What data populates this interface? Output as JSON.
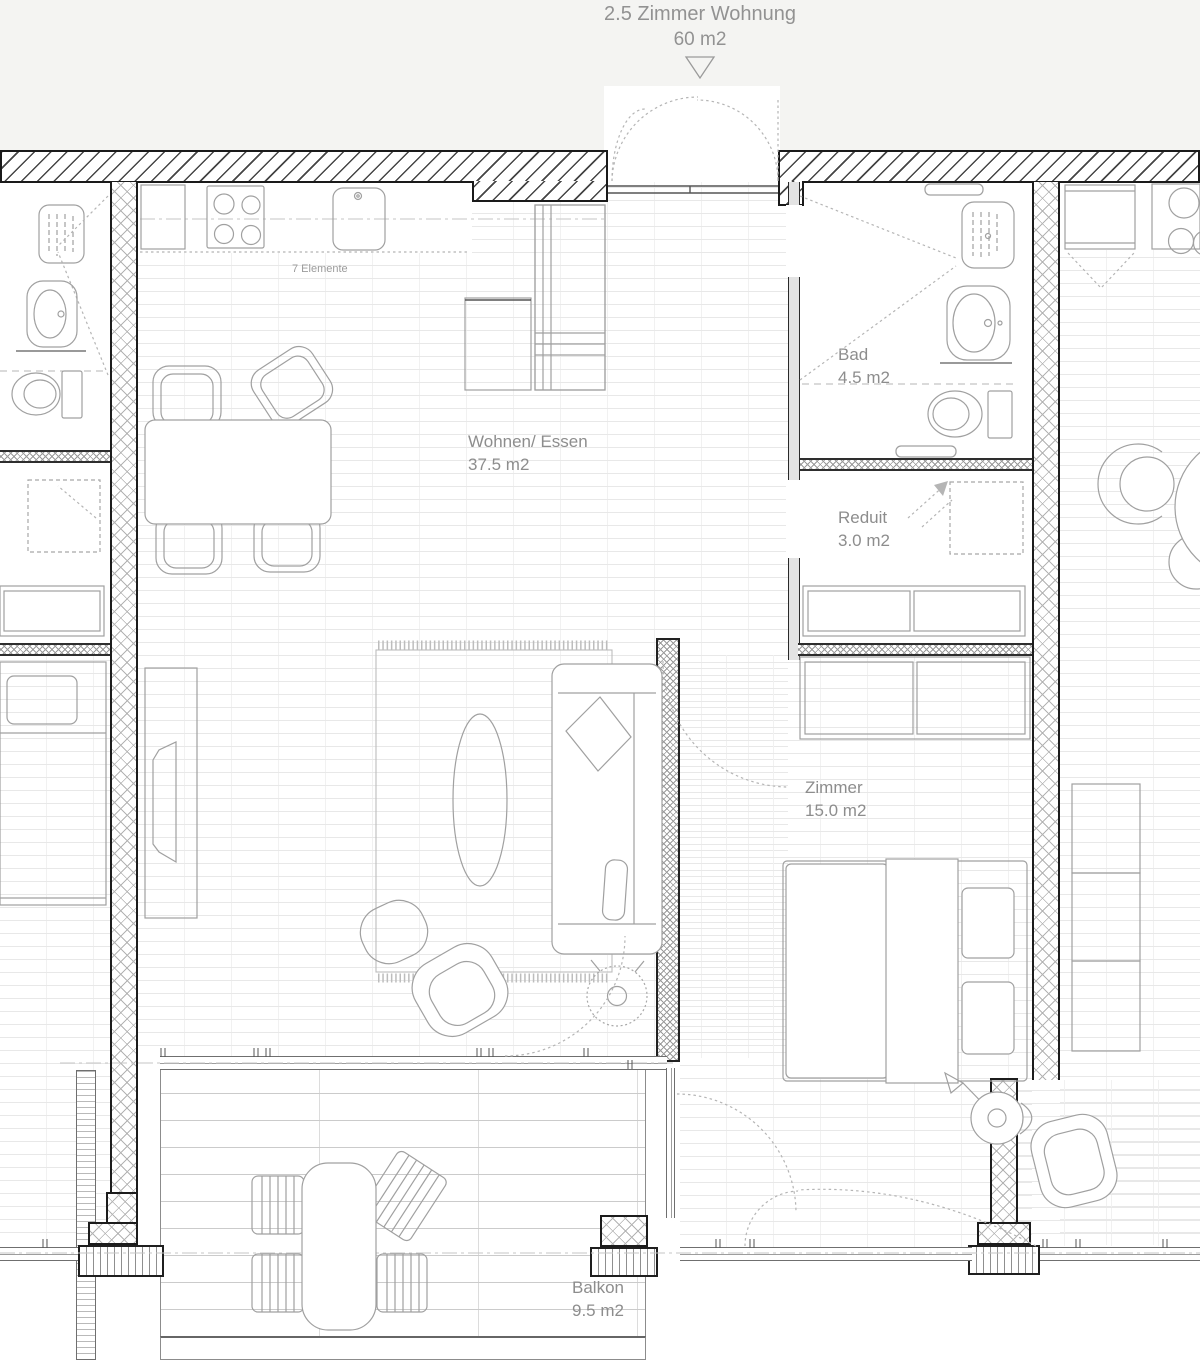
{
  "header": {
    "title": "2.5 Zimmer Wohnung",
    "subtitle": "60 m2"
  },
  "labels": {
    "kitchen_note": "7 Elemente",
    "living": {
      "name": "Wohnen/ Essen",
      "area": "37.5 m2"
    },
    "bath": {
      "name": "Bad",
      "area": "4.5 m2"
    },
    "storage": {
      "name": "Reduit",
      "area": "3.0 m2"
    },
    "bedroom": {
      "name": "Zimmer",
      "area": "15.0 m2"
    },
    "balcony": {
      "name": "Balkon",
      "area": "9.5 m2"
    }
  },
  "colors": {
    "paper": "#ffffff",
    "top_band": "#f4f4f2",
    "wall_outline": "#1a1a1a",
    "hatch_line": "#b3b3b3",
    "furniture_line": "#a0a0a0",
    "floor_brick_line": "#e8e8e8",
    "label_text": "#8d8d8d"
  }
}
